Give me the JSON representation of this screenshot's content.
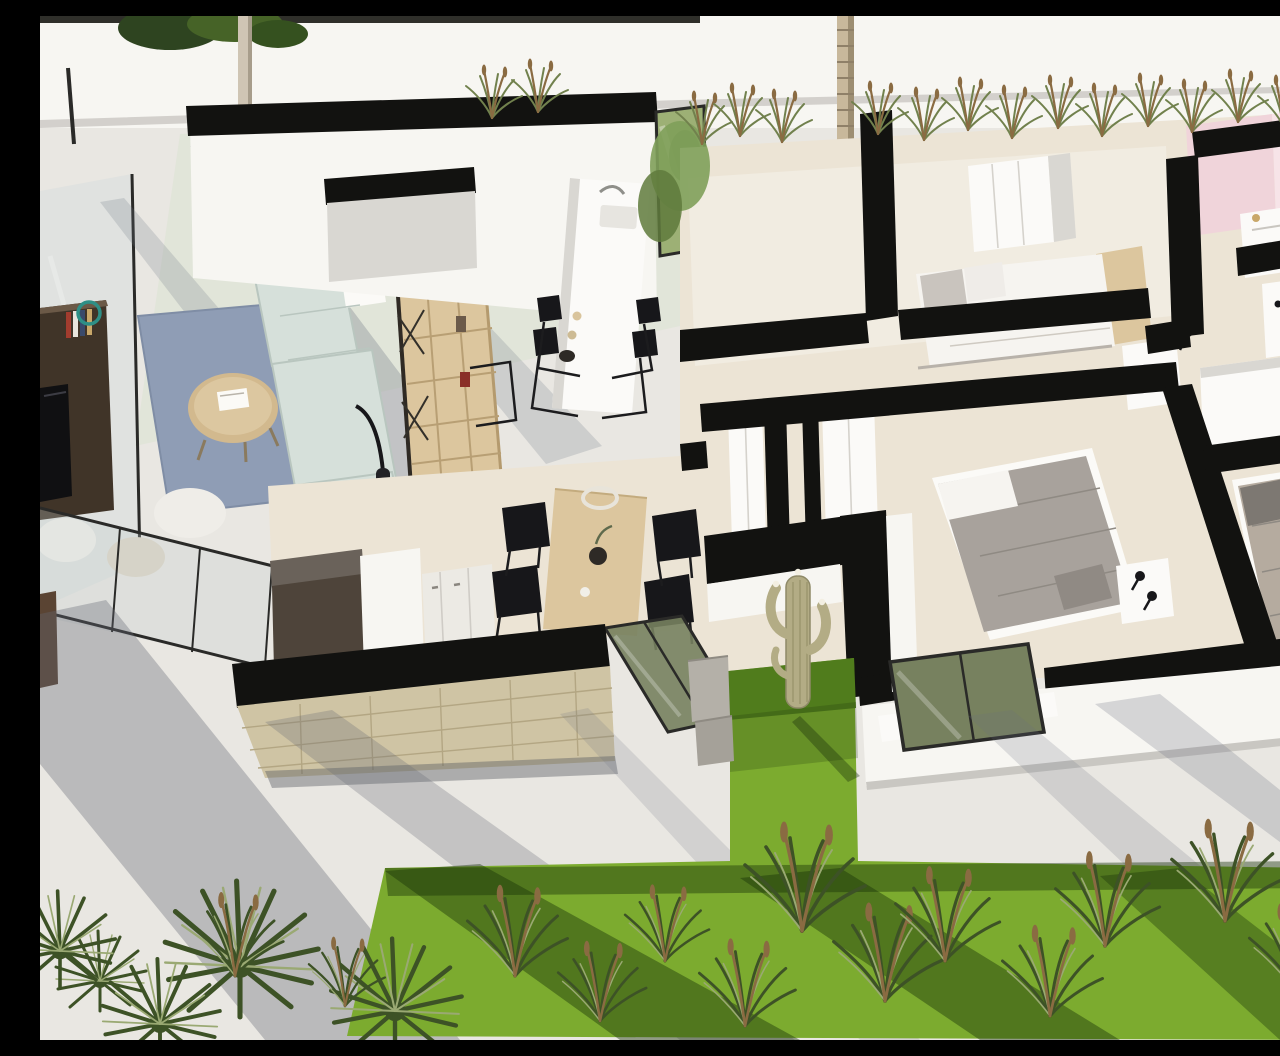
{
  "meta": {
    "description": "Aerial 3D cutaway render of a modern single-storey villa: open living terrace with lounge furniture, linear kitchen island and dining table, three furnished bedrooms, pink bathroom, interior palm courtyard, stone-clad wall, white paved terraces and a landscaped lawn with ornamental grasses and fan palms",
    "render_type": "architectural-3d-floor-plan"
  },
  "colors": {
    "pave": "#e9e7e2",
    "wallTop": "#121210",
    "wallWhite": "#f7f6f2",
    "wallShade": "#d9d7d2",
    "floorBeige": "#ece4d5",
    "floorPale": "#f1ece1",
    "grass": "#7cab2f",
    "grassDark": "#507c1c",
    "grassShadow": "rgba(22,48,8,0.42)",
    "plantDark": "#3d5226",
    "plantOlive": "#71814d",
    "plantLight": "#9aa973",
    "spikeBrown": "#8a6b42",
    "rugBlue": "#8f9db5",
    "sofaMint": "#d6e0da",
    "sofaLine": "#b9c6bf",
    "woodLight": "#dcc69e",
    "woodMid": "#d2b98e",
    "woodDark": "#403428",
    "stone": "#cfc4a4",
    "stoneLine": "#b3a683",
    "gravelGrey": "#9aa2aa",
    "gravelDark": "#4b4f52",
    "glassGreen": "#9db075",
    "glassDarkGreen": "#77815f",
    "bedWhite": "#f6f4f0",
    "bedGrey": "#a8a29c",
    "bedBeige": "#b5ab9f",
    "pillowGrey": "#7d7872",
    "pinkWall": "#f0d4da",
    "pinkWallLight": "#f7e4e8",
    "treeTrunk": "#cfc5b4",
    "palmTrunk": "#c8b89b",
    "cactus": "#b3ac85",
    "metalDark": "#2a2a28",
    "tealAccent": "#2e8f86",
    "bookRed": "#a23c2e",
    "shadowCool": "rgba(105,112,128,0.30)",
    "shadowWarm": "rgba(100,104,114,0.35)"
  },
  "scene": {
    "rooms": [
      "living-lounge-terrace",
      "kitchen-dining",
      "palm-courtyard",
      "bedroom-main",
      "bedroom-two",
      "bedroom-three",
      "pink-bathroom",
      "hallway",
      "garden-lawn"
    ],
    "furniture": [
      "sectional-sofa",
      "round-coffee-table",
      "area-rug",
      "bookshelf",
      "media-sideboard",
      "floor-lamp",
      "poufs",
      "kitchen-island-with-sink",
      "bar-chairs",
      "dining-table",
      "dining-chairs",
      "double-beds",
      "nightstands",
      "wardrobes",
      "bathroom-vanity"
    ],
    "vegetation": [
      "street-tree",
      "palm-tree-trunk",
      "ornamental-grasses",
      "fan-palms",
      "saguaro-cactus",
      "lawn"
    ]
  }
}
